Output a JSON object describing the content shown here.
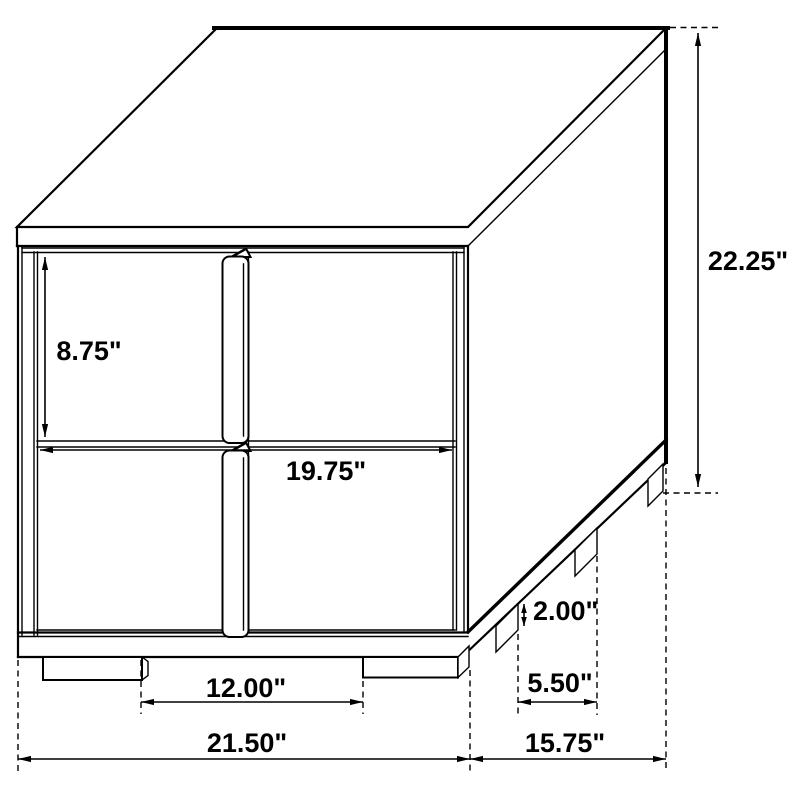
{
  "diagram": {
    "title": "nightstand-dimension-diagram",
    "object": "two-drawer nightstand, isometric line drawing",
    "background_color": "#ffffff",
    "line_color": "#000000",
    "labels": {
      "height": "22.25\"",
      "drawer_height": "8.75\"",
      "drawer_width": "19.75\"",
      "front_feet_gap": "12.00\"",
      "overall_width": "21.50\"",
      "base_height": "2.00\"",
      "side_feet_gap": "5.50\"",
      "depth": "15.75\""
    }
  }
}
